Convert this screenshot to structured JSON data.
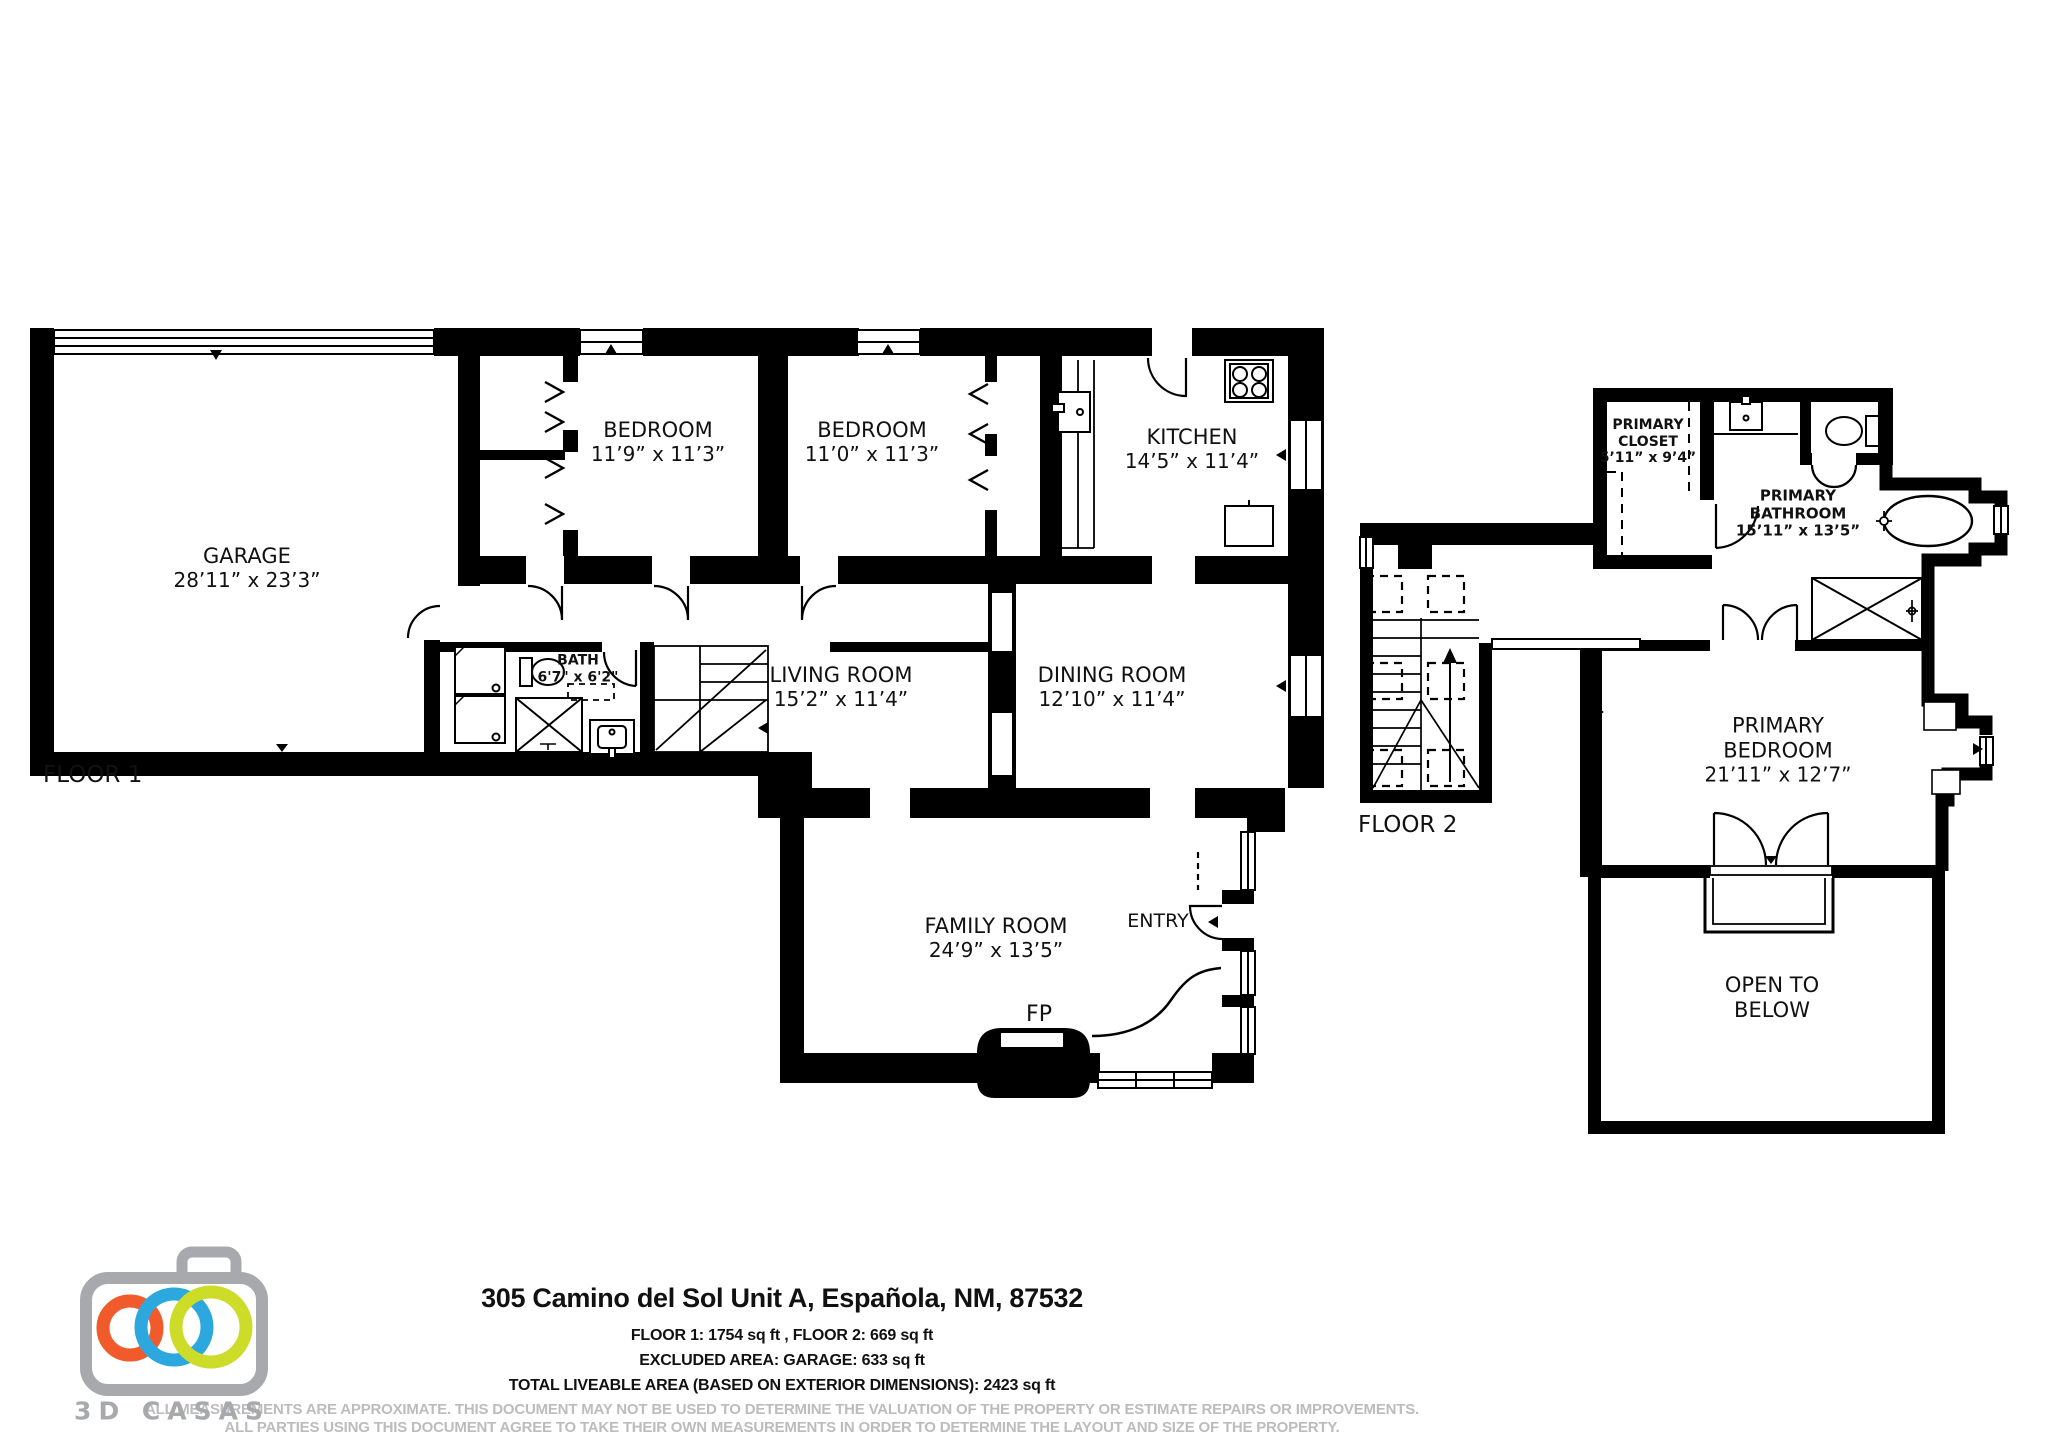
{
  "colors": {
    "wall": "#000000",
    "background": "#ffffff",
    "disclaimer_gray": "#bcbcbc",
    "logo_gray": "#a7a9ac",
    "logo_orange": "#f15b2b",
    "logo_blue": "#2ca8df",
    "logo_green": "#cddc29"
  },
  "floor1": {
    "label": "FLOOR 1",
    "garage": {
      "name": "GARAGE",
      "dims": "28’11” x 23’3”"
    },
    "bedroom1": {
      "name": "BEDROOM",
      "dims": "11’9” x 11’3”"
    },
    "bedroom2": {
      "name": "BEDROOM",
      "dims": "11’0” x 11’3”"
    },
    "kitchen": {
      "name": "KITCHEN",
      "dims": "14’5” x 11’4”"
    },
    "bath": {
      "name": "BATH",
      "dims": "6'7\" x 6'2\""
    },
    "living": {
      "name": "LIVING ROOM",
      "dims": "15’2” x 11’4”"
    },
    "dining": {
      "name": "DINING ROOM",
      "dims": "12’10” x 11’4”"
    },
    "family": {
      "name": "FAMILY ROOM",
      "dims": "24’9” x 13’5”"
    },
    "entry": {
      "name": "ENTRY"
    },
    "fireplace": {
      "name": "FP"
    }
  },
  "floor2": {
    "label": "FLOOR 2",
    "closet": {
      "line1": "PRIMARY",
      "line2": "CLOSET",
      "dims": "5’11” x 9’4”"
    },
    "bathroom": {
      "line1": "PRIMARY",
      "line2": "BATHROOM",
      "dims": "15’11” x 13’5”"
    },
    "bedroom": {
      "line1": "PRIMARY",
      "line2": "BEDROOM",
      "dims": "21’11” x 12’7”"
    },
    "open_to_below": {
      "line1": "OPEN TO",
      "line2": "BELOW"
    }
  },
  "footer": {
    "address": "305 Camino del Sol Unit A, Española, NM, 87532",
    "line1": "FLOOR 1: 1754 sq ft , FLOOR 2: 669 sq ft",
    "line2": "EXCLUDED AREA: GARAGE: 633 sq ft",
    "line3": "TOTAL LIVEABLE AREA (BASED ON EXTERIOR DIMENSIONS): 2423 sq ft",
    "disclaimer1": "ALL MEASUREMENTS ARE APPROXIMATE. THIS DOCUMENT MAY NOT BE USED TO DETERMINE THE VALUATION OF THE PROPERTY OR ESTIMATE REPAIRS OR IMPROVEMENTS.",
    "disclaimer2": "ALL PARTIES USING THIS DOCUMENT AGREE TO TAKE THEIR OWN MEASUREMENTS IN ORDER TO DETERMINE THE LAYOUT AND SIZE OF THE PROPERTY."
  },
  "logo": {
    "brand": "3D CASAS"
  }
}
